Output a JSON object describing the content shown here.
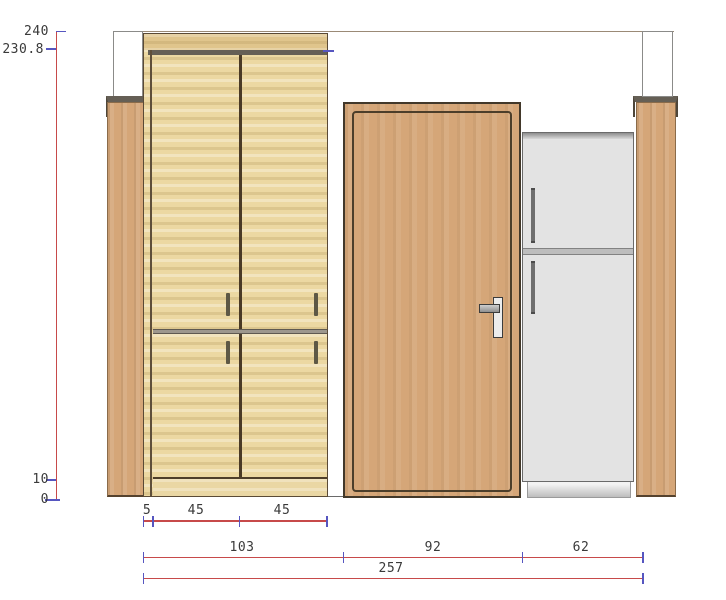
{
  "drawing": {
    "type": "furniture-elevation",
    "dims": {
      "vertical": {
        "ceiling": "240",
        "wardrobe_top": "230.8",
        "plinth": "10",
        "floor": "0"
      },
      "wardrobe": {
        "side": "5",
        "left_door": "45",
        "right_door": "45"
      },
      "segments": {
        "wardrobe": "103",
        "door": "92",
        "fridge": "62"
      },
      "total": "257"
    }
  },
  "colors": {
    "dim-line": "#c74a4a",
    "dim-tick": "#5656c0",
    "dim-text": "#3a3a3a",
    "wood-light-a": "#ecd8a2",
    "wood-tan-a": "#d5a678",
    "outline-dark": "#42382a",
    "band-gray": "#655f55",
    "fridge-gray": "#e3e3e3",
    "ceiling-line": "#9b8a76",
    "column-border": "#8b8b89",
    "mid-rail": "#9d978d"
  }
}
